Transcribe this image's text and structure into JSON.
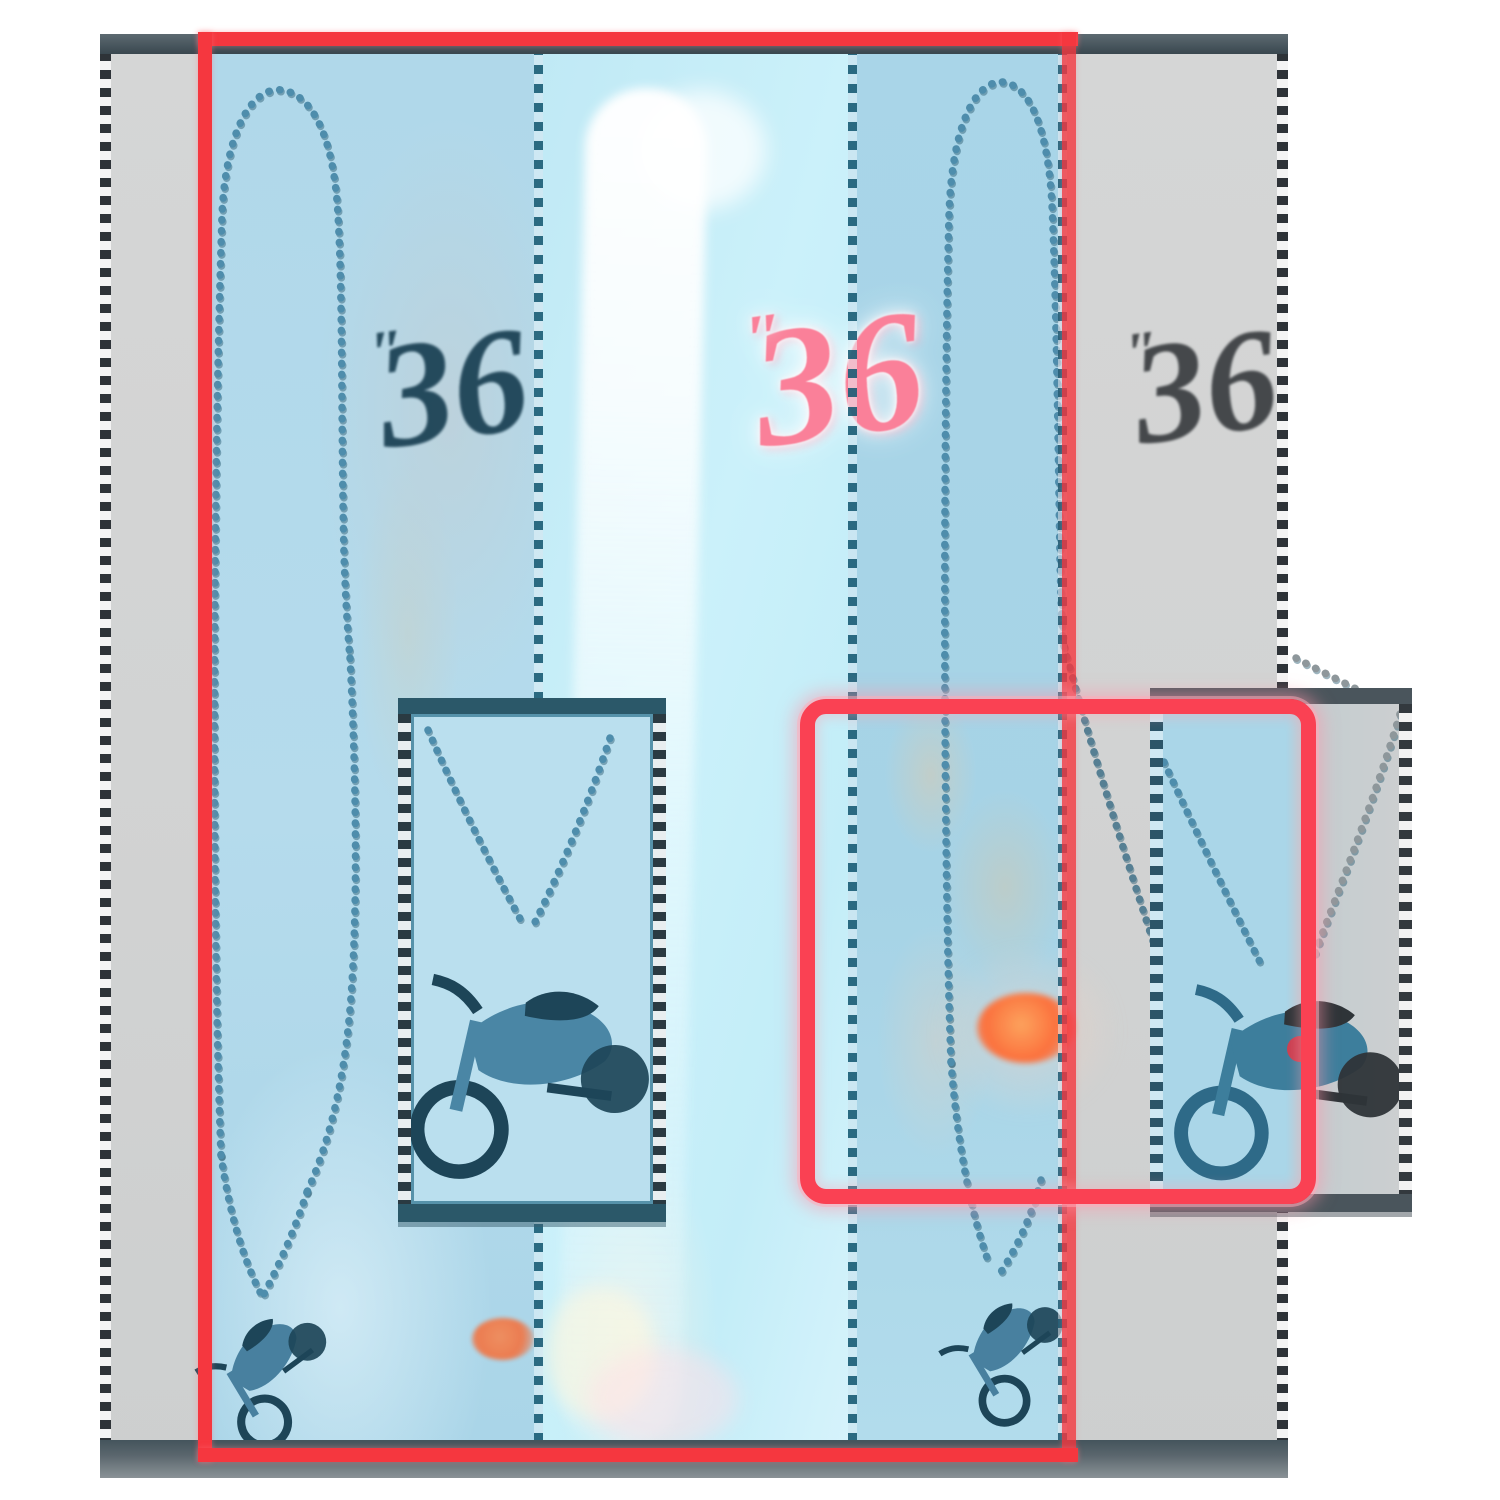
{
  "scene": {
    "description": "Necklace size comparison collage: 36-inch ball chain necklaces with motorcycle pendants displayed on gray cards with blue strips, annotated with red measurement rectangles and two magnified pendant inset boxes",
    "labels": {
      "left": {
        "value": "36",
        "unit": "″"
      },
      "center": {
        "value": "36",
        "unit": "″"
      },
      "right": {
        "value": "36",
        "unit": "″"
      }
    },
    "colors": {
      "background": "#ffffff",
      "card_gray": "#d2d3d3",
      "card_border_dark": "#3e4d56",
      "photo_blue_left": "#b3d9ea",
      "photo_blue_right": "#a7d3e6",
      "middle_cyan": "#c6eef8",
      "measure_red": "#f5373f",
      "highlight_red_pink": "#fa4153",
      "chain_teal": "#4e8dac",
      "label_dark_left": "#1d4356",
      "label_dark_right": "#45484b",
      "label_pink": "#fa8099",
      "orange_glare": "#f4703c"
    }
  }
}
